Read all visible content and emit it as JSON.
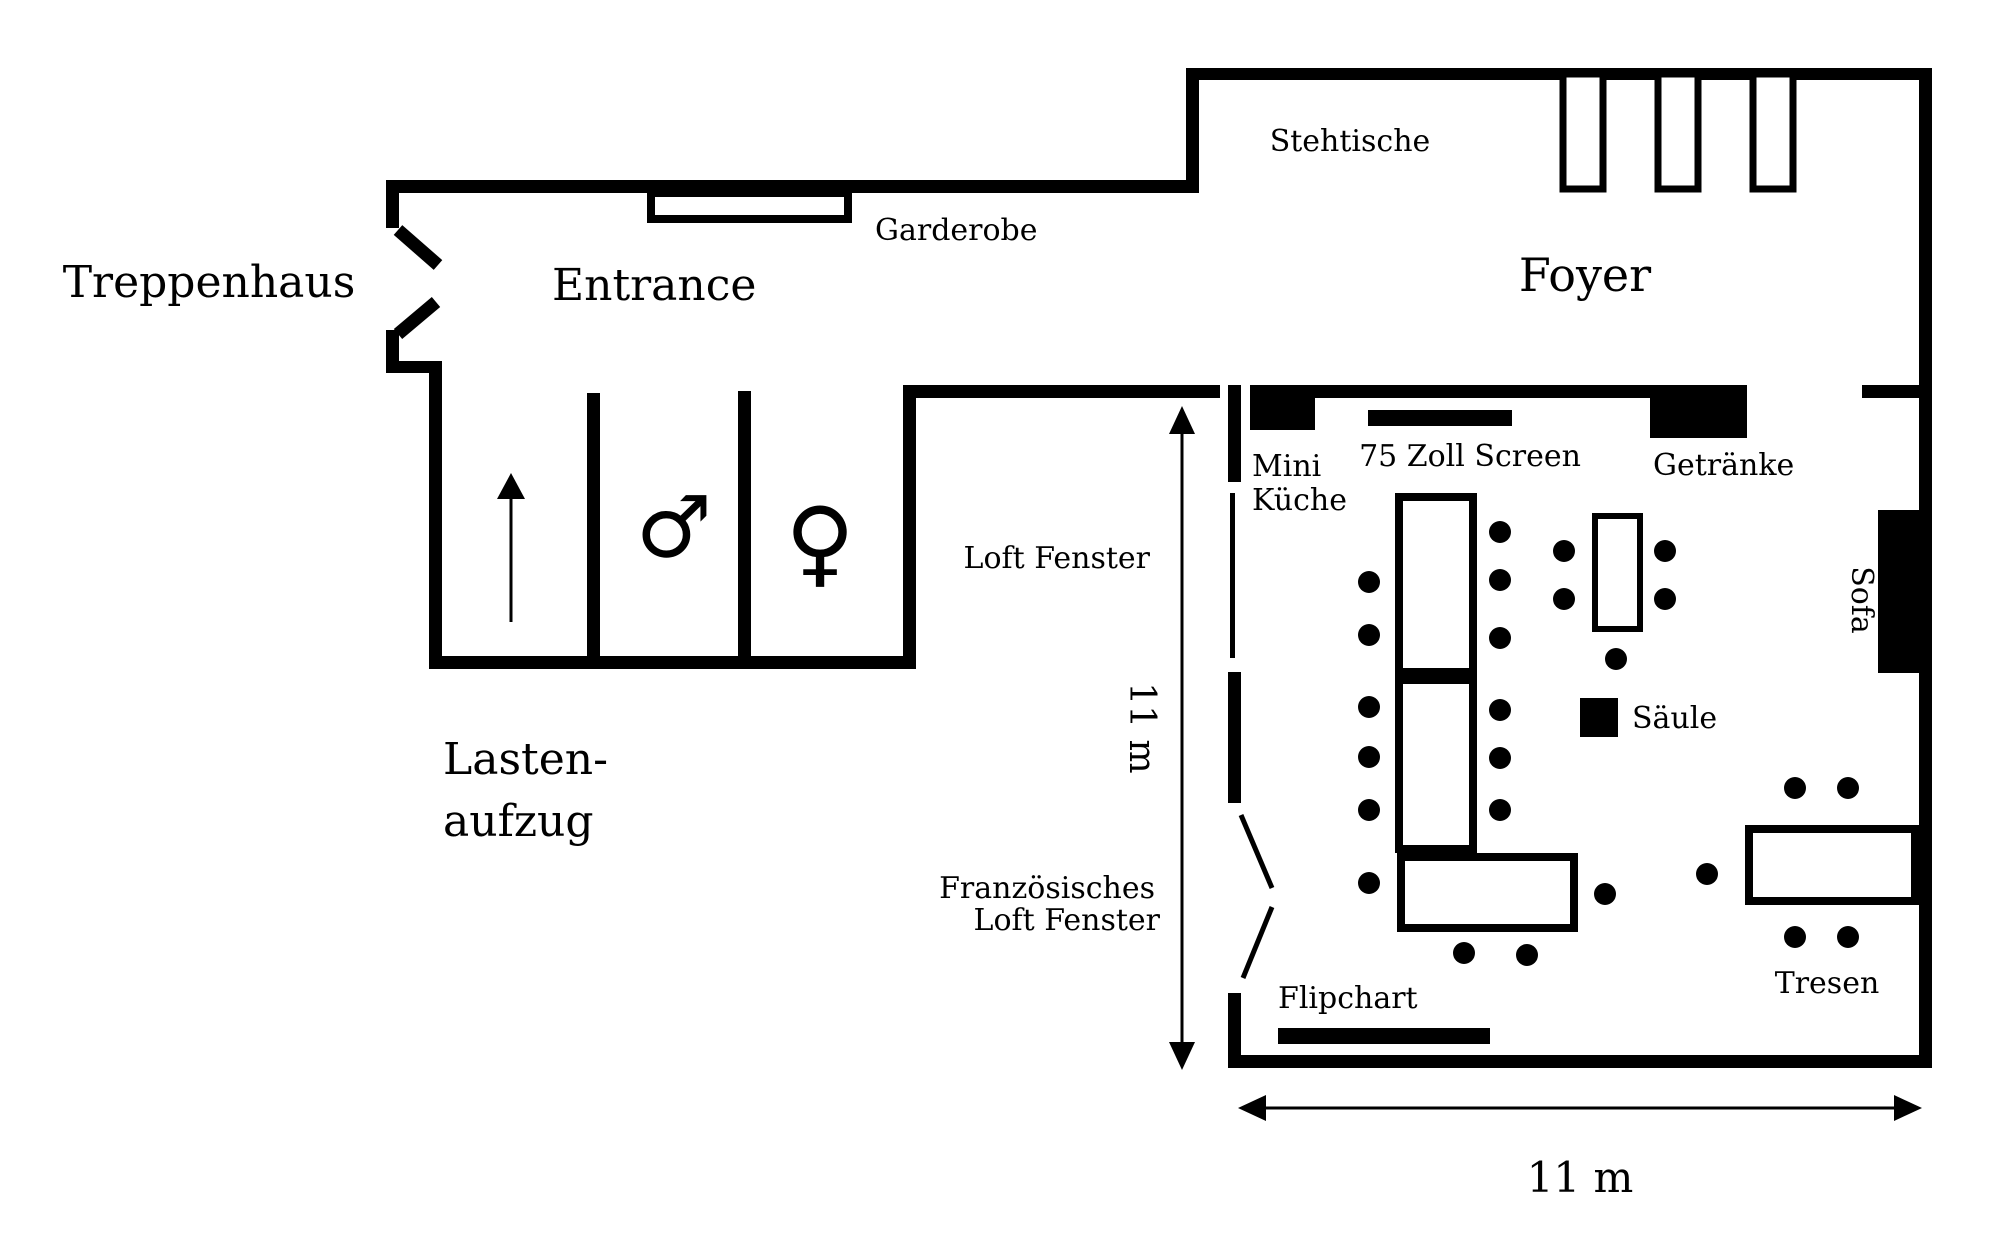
{
  "labels": {
    "treppenhaus": "Treppenhaus",
    "entrance": "Entrance",
    "garderobe": "Garderobe",
    "foyer": "Foyer",
    "stehtische": "Stehtische",
    "lastenaufzug_line1": "Lasten-",
    "lastenaufzug_line2": "aufzug",
    "mini_kueche_line1": "Mini",
    "mini_kueche_line2": "Küche",
    "screen": "75 Zoll Screen",
    "getraenke": "Getränke",
    "loft_fenster": "Loft Fenster",
    "franz_loft_fenster_line1": "Französisches",
    "franz_loft_fenster_line2": "Loft Fenster",
    "flipchart": "Flipchart",
    "saeule": "Säule",
    "sofa": "Sofa",
    "tresen": "Tresen"
  },
  "dimensions": {
    "room_width": "11 m",
    "room_height": "11 m"
  },
  "icons": {
    "male_symbol": "♂",
    "female_symbol": "♀",
    "elevator_arrow": "up-arrow"
  },
  "colors": {
    "wall": "#000000",
    "background": "#ffffff"
  }
}
